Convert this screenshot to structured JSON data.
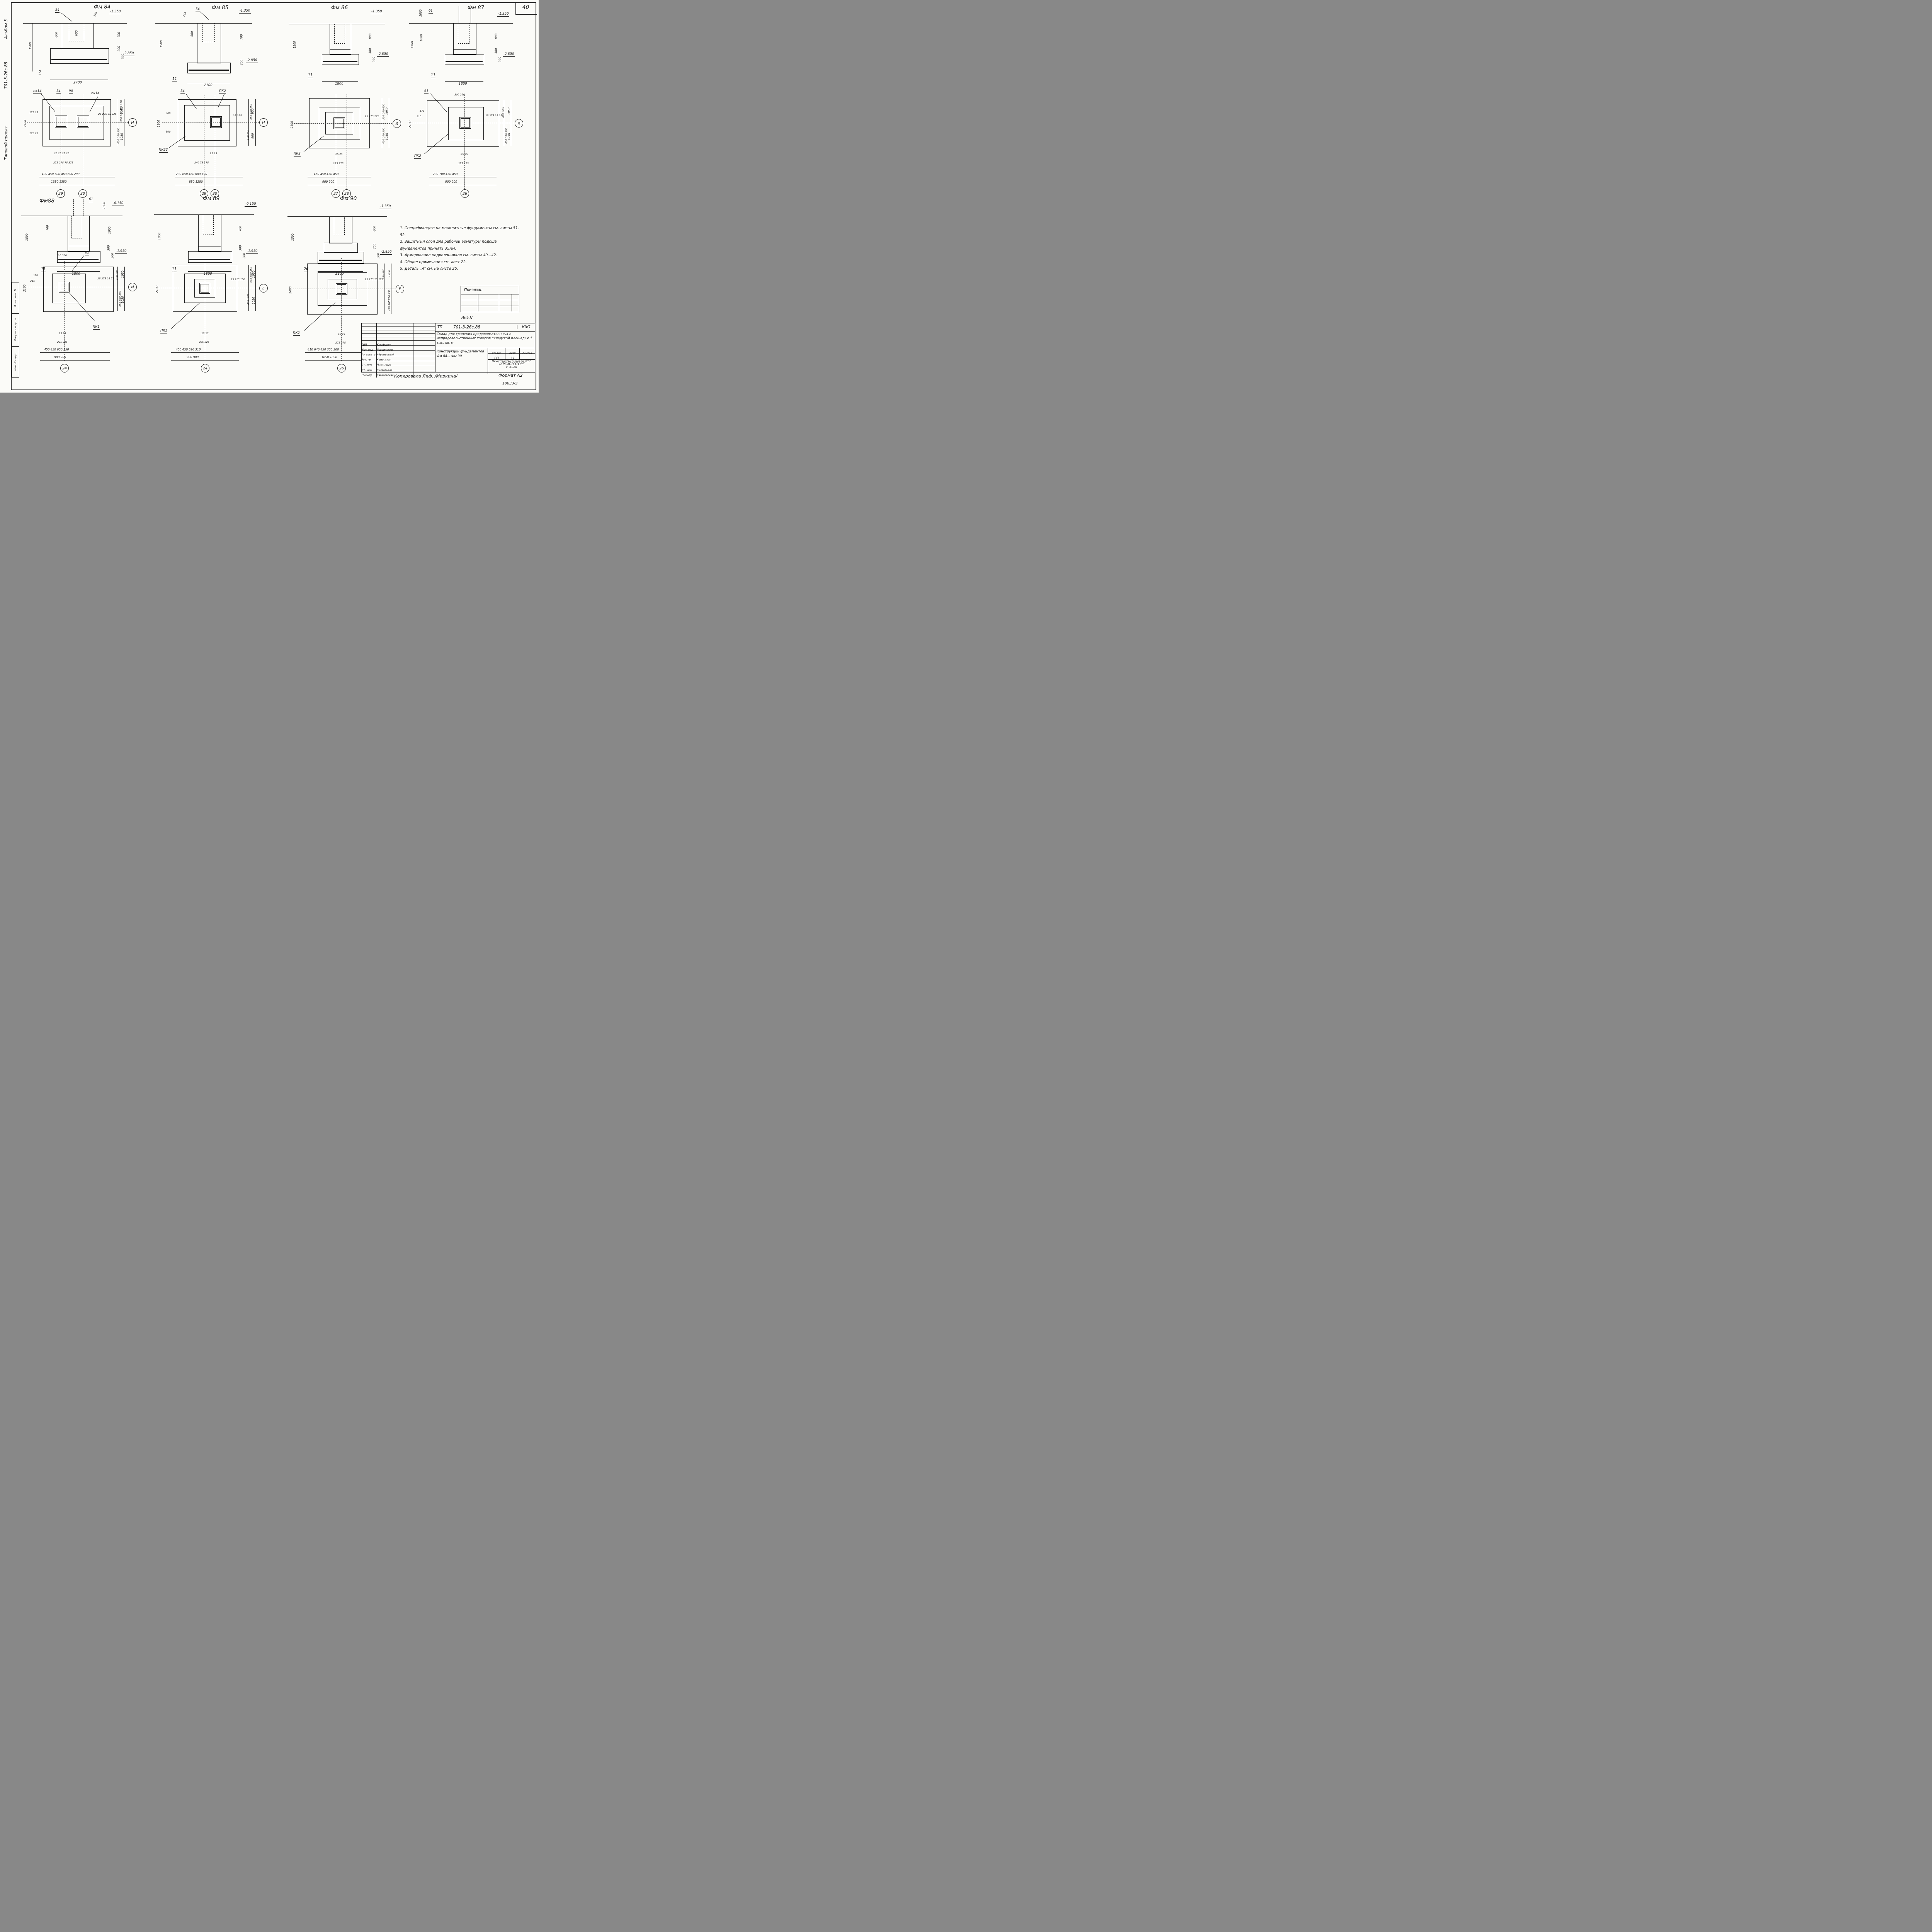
{
  "page": {
    "sheet_number": "40",
    "format_label": "Формат А2",
    "doc_number": "10033/3",
    "copied_label": "Копировала Лиф. /Миркина/"
  },
  "margin": {
    "vertical_texts": [
      "Типовой проект",
      "701-3-26с.88",
      "Альбом 3"
    ],
    "stamp_cells": [
      "Взам. инв. N",
      "Подпись и дата",
      "Инв. N подл."
    ]
  },
  "notes": {
    "lines": [
      "1. Спецификацию на монолитные фундаменты см. листы 51, 52.",
      "2. Защитный слой для рабочей арматуры подошв фундаментов принять 35мм.",
      "3. Армирование подколонников см. листы 40...42.",
      "4. Общие примечания см. лист 22.",
      "5. Деталь „А\" см. на листе 25."
    ]
  },
  "sections": [
    {
      "title": "Фм 84",
      "leader": "54",
      "top_small": "110",
      "elev_top": "-1.350",
      "elev_bot": "-2.850",
      "left_dim": "1500",
      "col_dim": "800",
      "glass_dim": "600",
      "right_dims": [
        "700",
        "300",
        "300"
      ],
      "ref": "2",
      "width": "2700"
    },
    {
      "title": "Фм 85",
      "leader": "54",
      "top_small": "110",
      "elev_top": "-1.350",
      "elev_bot": "-2.850",
      "left_dim": "1500",
      "glass_dim": "600",
      "right_dims": [
        "700",
        "300"
      ],
      "ref": "11",
      "width": "2100"
    },
    {
      "title": "Фм 86",
      "elev_top": "-1.350",
      "elev_bot": "-2.850",
      "left_dim": "1500",
      "right_dims": [
        "800",
        "300",
        "300"
      ],
      "ref": "11",
      "width": "1800"
    },
    {
      "title": "Фм 87",
      "leader": "61",
      "top_dim": "1000",
      "elev_top": "-1.350",
      "elev_bot": "-2.850",
      "left_dim": "1500",
      "col_dim": "1000",
      "right_dims": [
        "800",
        "300",
        "300"
      ],
      "ref": "11",
      "width": "1800"
    },
    {
      "title": "Фм88",
      "leader": "61",
      "top_dim": "1000",
      "elev_top": "-0.150",
      "elev_bot": "-1.950",
      "left_dim": "1800",
      "col_dim": "700",
      "right_dims": [
        "1000",
        "300",
        "300"
      ],
      "ref": "11",
      "width": "1800"
    },
    {
      "title": "Фм 89",
      "elev_top": "-0.150",
      "elev_bot": "-1.950",
      "left_dim": "1800",
      "right_dims": [
        "700",
        "300",
        "300"
      ],
      "ref": "11",
      "width": "1800"
    },
    {
      "title": "Фм 90",
      "elev_top": "-1.350",
      "elev_bot": "-2.850",
      "left_dim": "1500",
      "right_dims": [
        "800",
        "300",
        "300"
      ],
      "ref": "26",
      "width": "2100"
    }
  ],
  "plans": [
    {
      "leaders": [
        "пк14",
        "54",
        "90",
        "пк14"
      ],
      "left_dim": "2100",
      "left_small": "275 25",
      "left_small2": "275 25",
      "tiny": "25 25    25 25",
      "mid": "275 275      75 375",
      "row1": "400 450 500 460 600 290",
      "row2": "1350          1350",
      "axes": [
        "29",
        "30"
      ],
      "right_tiny": "25 225  25 225",
      "right_small": "300 300 450 150",
      "right_small2": "450 300 300",
      "right_big": "1050",
      "right_big2": "1050",
      "axis_right": "И"
    },
    {
      "leaders": [
        "54",
        "ПК2"
      ],
      "pk_bottom": "ПК22",
      "left_dim": "1800",
      "left_small": "300",
      "left_small2": "300",
      "tiny": "25 25",
      "mid": "240   75 375",
      "row1": "200  650  460  600  190",
      "row2": "850      1250",
      "axes": [
        "29",
        "30"
      ],
      "right_tiny": "25 225",
      "right_small": "450 450 150",
      "right_small2": "450 150",
      "right_big": "900",
      "right_big2": "900",
      "axis_right": "Н"
    },
    {
      "pk_bottom": "ПК2",
      "left_dim": "2100",
      "tiny": "25 25",
      "mid": "275 275",
      "row1": "450  450  450  450",
      "row2": "900      900",
      "axes": [
        "27",
        "28"
      ],
      "right_tiny": "25 275 275",
      "right_small": "300 300 450",
      "right_small2": "450 300 300",
      "right_big": "1050",
      "right_big2": "1050",
      "axis_right": "И"
    },
    {
      "leaders": [
        "61"
      ],
      "top_dims": "300  290",
      "pk_bottom": "ПК2",
      "left_dim": "2100",
      "left_small": "170",
      "left_small2": "315",
      "tiny": "25 25",
      "mid": "275 275",
      "row1": "200  700  450  450",
      "row2": "900      900",
      "axes": [
        "26"
      ],
      "right_tiny": "25 275  25 275",
      "right_small": "450 600",
      "right_small2": "450 300 300",
      "right_big": "1050",
      "right_big2": "1050",
      "axis_right": "И"
    },
    {
      "leaders": [
        "61"
      ],
      "top_dims": "210  300",
      "pk_bottom": "ПК1",
      "left_dim": "2100",
      "left_small": "170",
      "left_small2": "315",
      "tiny": "25 25",
      "mid": "225 225",
      "row1": "450  450  650  250",
      "row2": "900      900",
      "axes": [
        "24"
      ],
      "right_tiny": "25 275  25 75",
      "right_small": "450 600",
      "right_small2": "450 300 300",
      "right_big": "1050",
      "right_big2": "1050",
      "axis_right": "И"
    },
    {
      "pk_bottom": "ПК1",
      "left_dim": "2100",
      "tiny": "25 25",
      "mid": "225 225",
      "row1": "450  450  590  310",
      "row2": "900      900",
      "axes": [
        "24"
      ],
      "right_tiny": "25 225 150",
      "right_small": "300 300 450",
      "right_small2": "450 300",
      "right_big": "1050",
      "right_big2": "1050",
      "axis_right": "Е"
    },
    {
      "pk_bottom": "ПК2",
      "left_dim": "2400",
      "tiny": "25 25",
      "mid": "275 275",
      "row1": "410  640  450  300  300",
      "row2": "1050      1050",
      "axes": [
        "26"
      ],
      "right_tiny": "25 275  25 275",
      "right_small": "450 450",
      "right_small2": "450 300 300 450",
      "right_big": "1200",
      "right_big2": "1200",
      "axis_right": "Е"
    }
  ],
  "title_block": {
    "tp": "ТП",
    "code": "701-3-26с.88",
    "mark": "КЖ1",
    "object": "Склад для хранения продовольственных и непродовольственных товаров складской площадью 5 тыс. кв. м",
    "sheet_title": "Конструкции фундаментов Фм 84... Фм 90",
    "stage_h": "Стадия",
    "list_h": "Лист",
    "lists_h": "Листов",
    "stage": "РП",
    "list": "37",
    "lists": "",
    "org1": "Министерство торговли УССР",
    "org2": "УКРГИПРОТОРГ",
    "org3": "г. Киев",
    "rows": [
      {
        "role": "ГИП",
        "name": "Юзефович"
      },
      {
        "role": "Нач. отд",
        "name": "Лавриненко"
      },
      {
        "role": "Гл. констр",
        "name": "Абрамовский"
      },
      {
        "role": "Рук. гр.",
        "name": "Каминская"
      },
      {
        "role": "Ст. инж",
        "name": "Мартыщук"
      },
      {
        "role": "Ст. инж",
        "name": "Силантьева"
      },
      {
        "role": "Н.контр",
        "name": "Кагановская"
      }
    ],
    "aux_label": "Привязан",
    "inv_label": "Инв.N"
  }
}
